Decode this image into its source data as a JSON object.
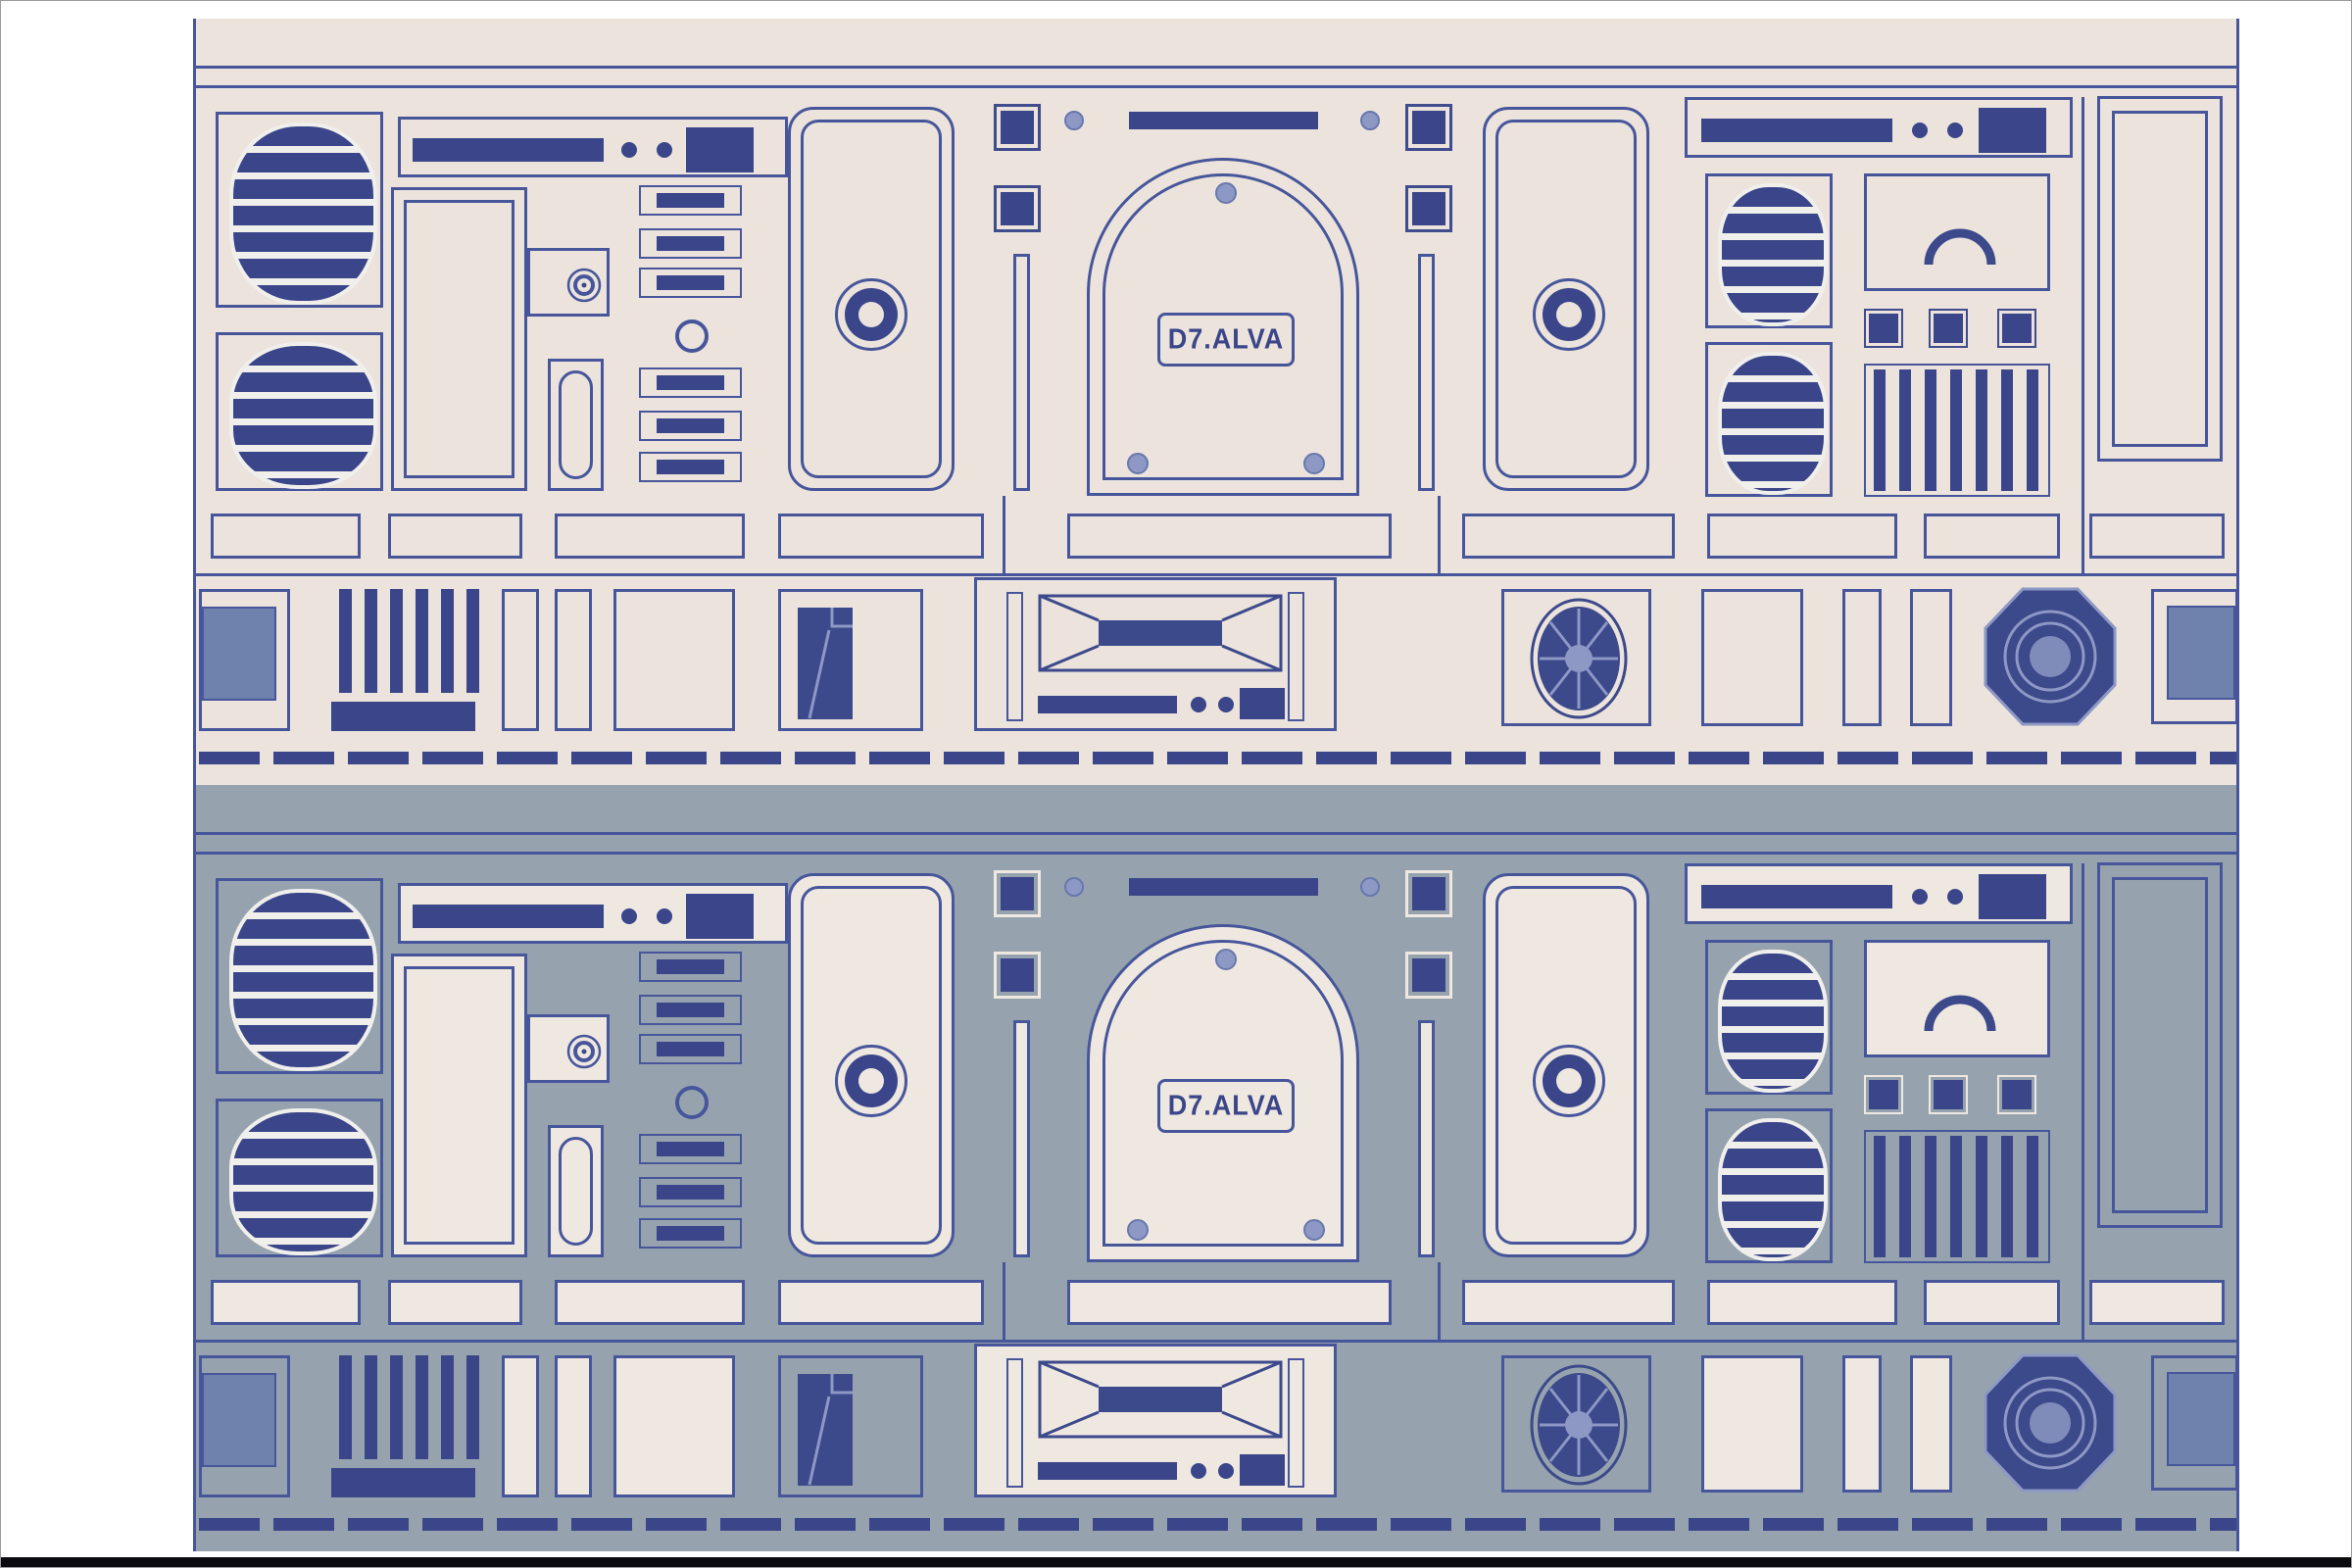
{
  "meta": {
    "description": "Astromech droid body-panel vector poster shown in two stacked color variants",
    "artwork_kind": "vector illustration pattern"
  },
  "logo": {
    "text": "D7.ALVA"
  },
  "units": [
    {
      "name": "panel-unit-cream",
      "variant": "cream",
      "background": "#ebe3dc"
    },
    {
      "name": "panel-unit-slate",
      "variant": "slate",
      "background": "#96a3ae"
    }
  ],
  "palette": {
    "cream_background": "#ebe3dc",
    "slate_background": "#96a3ae",
    "plate_cream": "#efe8e1",
    "navy_outline": "#47569b",
    "navy_fill": "#3c498b",
    "light_blue_rivet": "#8d98c5",
    "steel_blue_fill": "#6f82ae",
    "slat_light": "#f0efec",
    "page_white": "#ffffff",
    "bottom_strip_black": "#0b0b0e"
  },
  "icons": [
    "speaker-grille-icon",
    "vent-louver-icon",
    "ring-dial-icon",
    "door-ring-icon",
    "rivet-icon",
    "port-circle-icon",
    "arc-gauge-icon",
    "fan-icon",
    "octagon-coupling-icon",
    "bowtie-vent-icon",
    "boot-shape-icon",
    "dashed-tread-line"
  ]
}
